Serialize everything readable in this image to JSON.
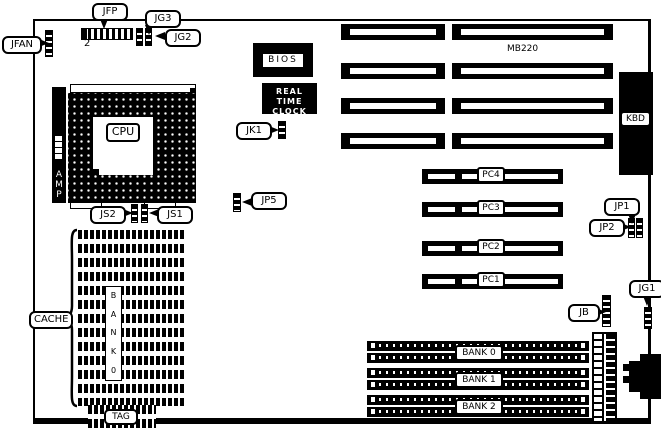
{
  "board": {
    "model": "MB220"
  },
  "connectors": {
    "jfan": "JFAN",
    "jfp": "JFP",
    "jfp_pin2": "2",
    "jg3": "JG3",
    "jg2": "JG2",
    "jk1": "JK1",
    "jp5": "JP5",
    "js2": "JS2",
    "js1": "JS1",
    "jp1": "JP1",
    "jp2": "JP2",
    "jg1": "JG1",
    "jb": "JB",
    "kbd": "KBD"
  },
  "chips": {
    "bios": "BIOS",
    "rtc_line1": "REAL TIME",
    "rtc_line2": "CLOCK",
    "cpu": "CPU",
    "amp_letters": [
      "A",
      "M",
      "P"
    ]
  },
  "cache": {
    "label": "CACHE",
    "bank_letters": [
      "B",
      "A",
      "N",
      "K",
      "0"
    ],
    "tag": "TAG"
  },
  "pci": {
    "slots": [
      "PC4",
      "PC3",
      "PC2",
      "PC1"
    ]
  },
  "memory": {
    "banks": [
      "BANK 0",
      "BANK 1",
      "BANK 2"
    ]
  }
}
